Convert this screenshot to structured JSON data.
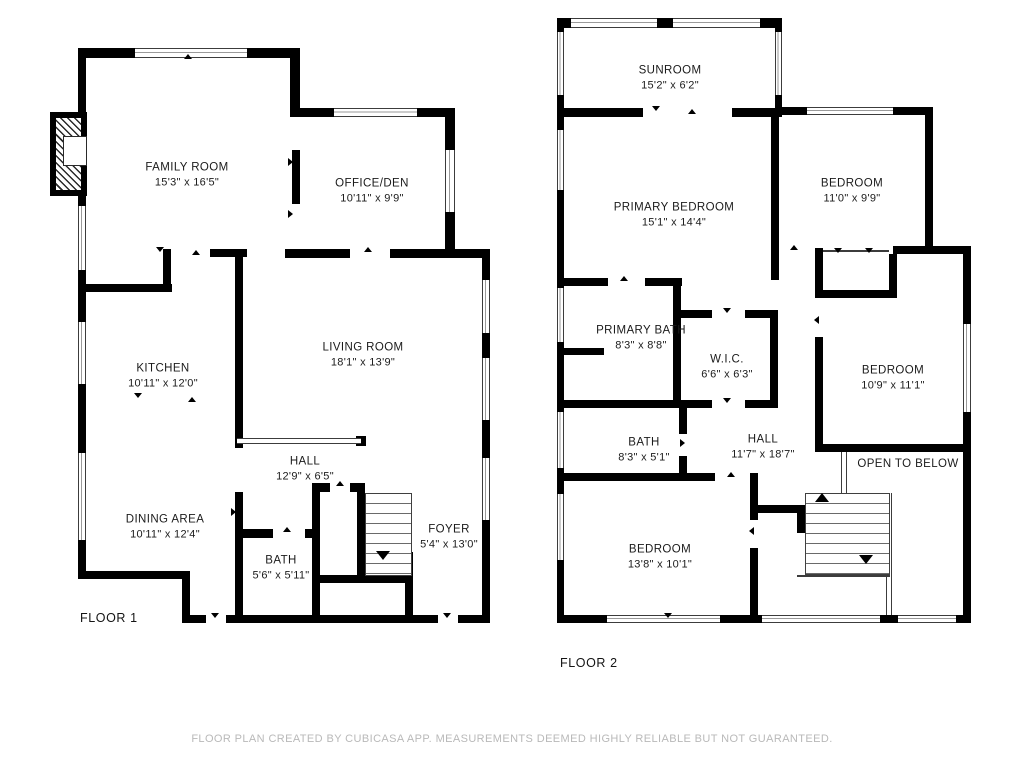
{
  "floors": [
    {
      "label": "FLOOR 1",
      "rooms": [
        {
          "name": "FAMILY ROOM",
          "dims": "15'3\" x 16'5\""
        },
        {
          "name": "OFFICE/DEN",
          "dims": "10'11\" x 9'9\""
        },
        {
          "name": "KITCHEN",
          "dims": "10'11\" x 12'0\""
        },
        {
          "name": "LIVING ROOM",
          "dims": "18'1\" x 13'9\""
        },
        {
          "name": "HALL",
          "dims": "12'9\" x 6'5\""
        },
        {
          "name": "DINING AREA",
          "dims": "10'11\" x 12'4\""
        },
        {
          "name": "BATH",
          "dims": "5'6\" x 5'11\""
        },
        {
          "name": "FOYER",
          "dims": "5'4\" x 13'0\""
        }
      ]
    },
    {
      "label": "FLOOR 2",
      "rooms": [
        {
          "name": "SUNROOM",
          "dims": "15'2\" x 6'2\""
        },
        {
          "name": "PRIMARY BEDROOM",
          "dims": "15'1\" x 14'4\""
        },
        {
          "name": "BEDROOM",
          "dims": "11'0\" x 9'9\""
        },
        {
          "name": "PRIMARY BATH",
          "dims": "8'3\" x 8'8\""
        },
        {
          "name": "W.I.C.",
          "dims": "6'6\" x 6'3\""
        },
        {
          "name": "BEDROOM",
          "dims": "10'9\" x 11'1\""
        },
        {
          "name": "BATH",
          "dims": "8'3\" x 5'1\""
        },
        {
          "name": "HALL",
          "dims": "11'7\" x 18'7\""
        },
        {
          "name": "OPEN TO BELOW",
          "dims": ""
        },
        {
          "name": "BEDROOM",
          "dims": "13'8\" x 10'1\""
        }
      ]
    }
  ],
  "disclaimer": "FLOOR PLAN CREATED BY CUBICASA APP. MEASUREMENTS DEEMED HIGHLY RELIABLE BUT NOT GUARANTEED.",
  "colors": {
    "wall": "#000000",
    "label_text": "#1b1b1b",
    "disclaimer_text": "#b9b9b9"
  }
}
